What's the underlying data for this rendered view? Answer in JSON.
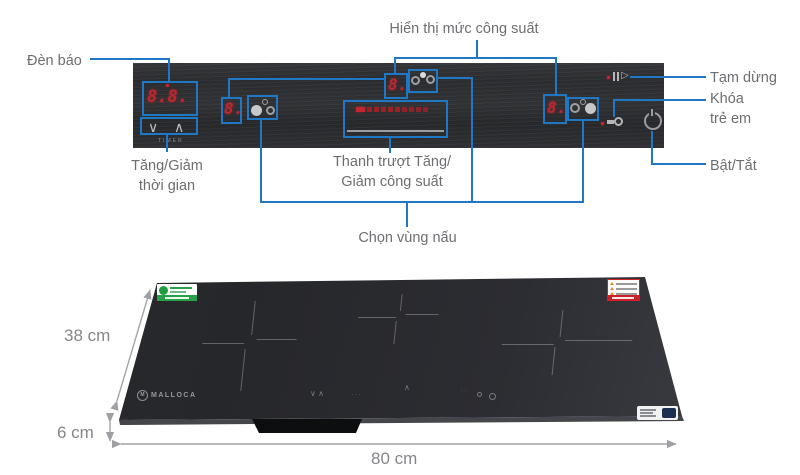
{
  "annotations": {
    "den_bao": "Đèn báo",
    "hien_thi_muc_cong_suat": "Hiển thị mức công suất",
    "tam_dung": "Tạm dừng",
    "khoa_tre_em": "Khóa\ntrẻ em",
    "bat_tat": "Bật/Tắt",
    "tang_giam_thoi_gian": "Tăng/Giảm\nthời gian",
    "thanh_truot": "Thanh trượt Tăng/\nGiảm công suất",
    "chon_vung_nau": "Chọn vùng nấu"
  },
  "panel": {
    "timer": {
      "display": "8.8.",
      "label": "TIMER",
      "down_glyph": "∨",
      "up_glyph": "∧"
    },
    "zones": [
      {
        "digit": "8."
      },
      {
        "digit": "8."
      },
      {
        "digit": "8."
      }
    ],
    "pause_glyph": "▷"
  },
  "cooktop": {
    "brand": "MALLOCA",
    "brand_mark": "M",
    "glass_touch": {
      "chevrons": "∨ ∧",
      "dots": "∙ ∙ ∙",
      "slider_mark": "∧",
      "power_dots": "∙ ∙"
    }
  },
  "dimensions": {
    "depth": "38 cm",
    "height": "6 cm",
    "width": "80 cm"
  },
  "colors": {
    "annotation_blue": "#2077c4",
    "label_gray": "#6d6e71",
    "display_red": "#bf2730",
    "panel_dark": "#2e2f32",
    "dimension_gray": "#85868a",
    "energy_label_green": "#27a04a",
    "warning_label_red": "#cf2027"
  }
}
